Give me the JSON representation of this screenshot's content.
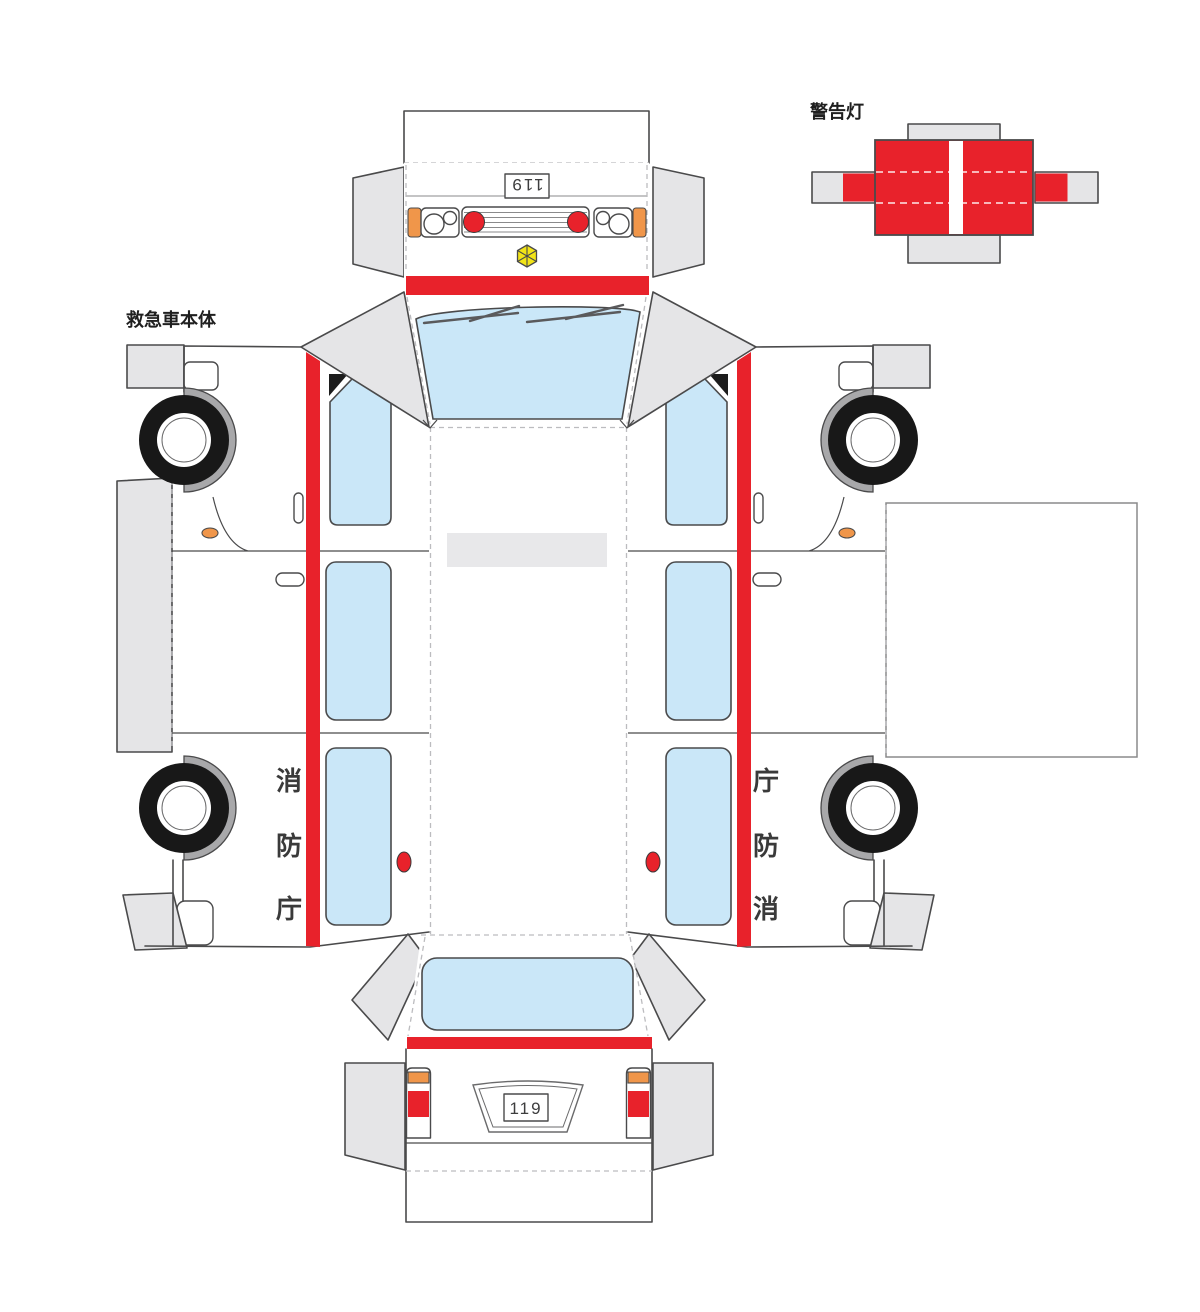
{
  "labels": {
    "ambulance_body": "救急車本体",
    "warning_light": "警告灯"
  },
  "front_plate": "119",
  "rear_plate": "119",
  "side_text_left": [
    "消",
    "防",
    "庁"
  ],
  "side_text_right": [
    "庁",
    "防",
    "消"
  ],
  "colors": {
    "stripe_red": "#e8222b",
    "window_blue": "#cae7f8",
    "signal_orange": "#f0964a",
    "badge_yellow": "#f2e417",
    "flap_gray": "#e5e5e7",
    "outline": "#4a4a4b"
  }
}
